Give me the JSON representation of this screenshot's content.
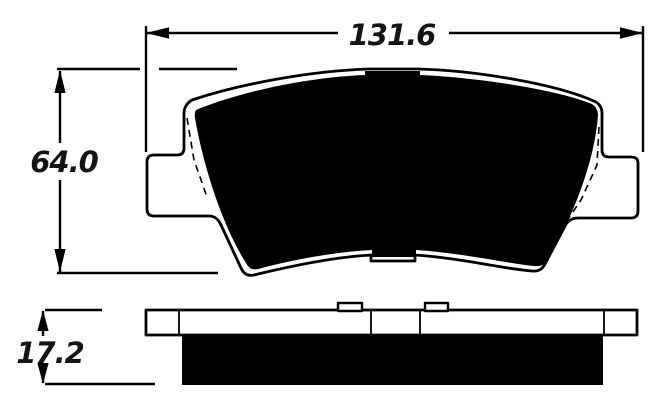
{
  "drawing": {
    "dimensions": {
      "width_mm": "131.6",
      "height_mm": "64.0",
      "thickness_mm": "17.2"
    },
    "colors": {
      "line": "#000000",
      "background": "#ffffff",
      "friction_fill": "#000000",
      "label_text": "#141414"
    },
    "views": {
      "front": "pad-front-view",
      "side": "pad-side-view"
    }
  }
}
